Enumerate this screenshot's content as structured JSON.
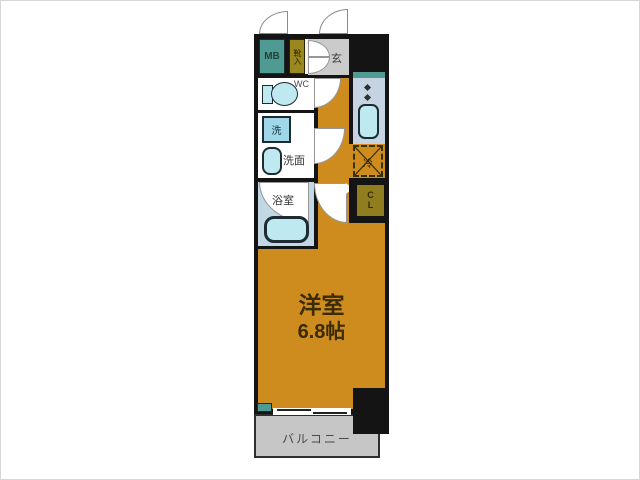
{
  "floorplan": {
    "rooms": {
      "mb": {
        "label": "MB"
      },
      "shoe_box": {
        "label": "靴入"
      },
      "entrance": {
        "label": "玄"
      },
      "wc": {
        "label": "WC"
      },
      "washer": {
        "label": "洗"
      },
      "washroom": {
        "label": "洗面"
      },
      "bathroom": {
        "label": "浴室"
      },
      "fridge": {
        "label": "冷"
      },
      "closet": {
        "label_top": "C",
        "label_bottom": "L"
      },
      "main_room": {
        "label": "洋室",
        "size": "6.8帖"
      },
      "balcony": {
        "label": "バルコニー"
      }
    },
    "colors": {
      "floor_orange": "#CE8C1E",
      "teal": "#4F9B93",
      "olive": "#9A871E",
      "closet_olive": "#8F7D20",
      "entrance_gray": "#CBCBCB",
      "balcony_gray": "#C6C6C6",
      "kitchen_bg": "#C5D3E2",
      "bath_bg": "#C3D8E5",
      "fixture_fill": "#BFE9F0",
      "washer_fill": "#9FD6E8",
      "wall_black": "#141414"
    }
  }
}
